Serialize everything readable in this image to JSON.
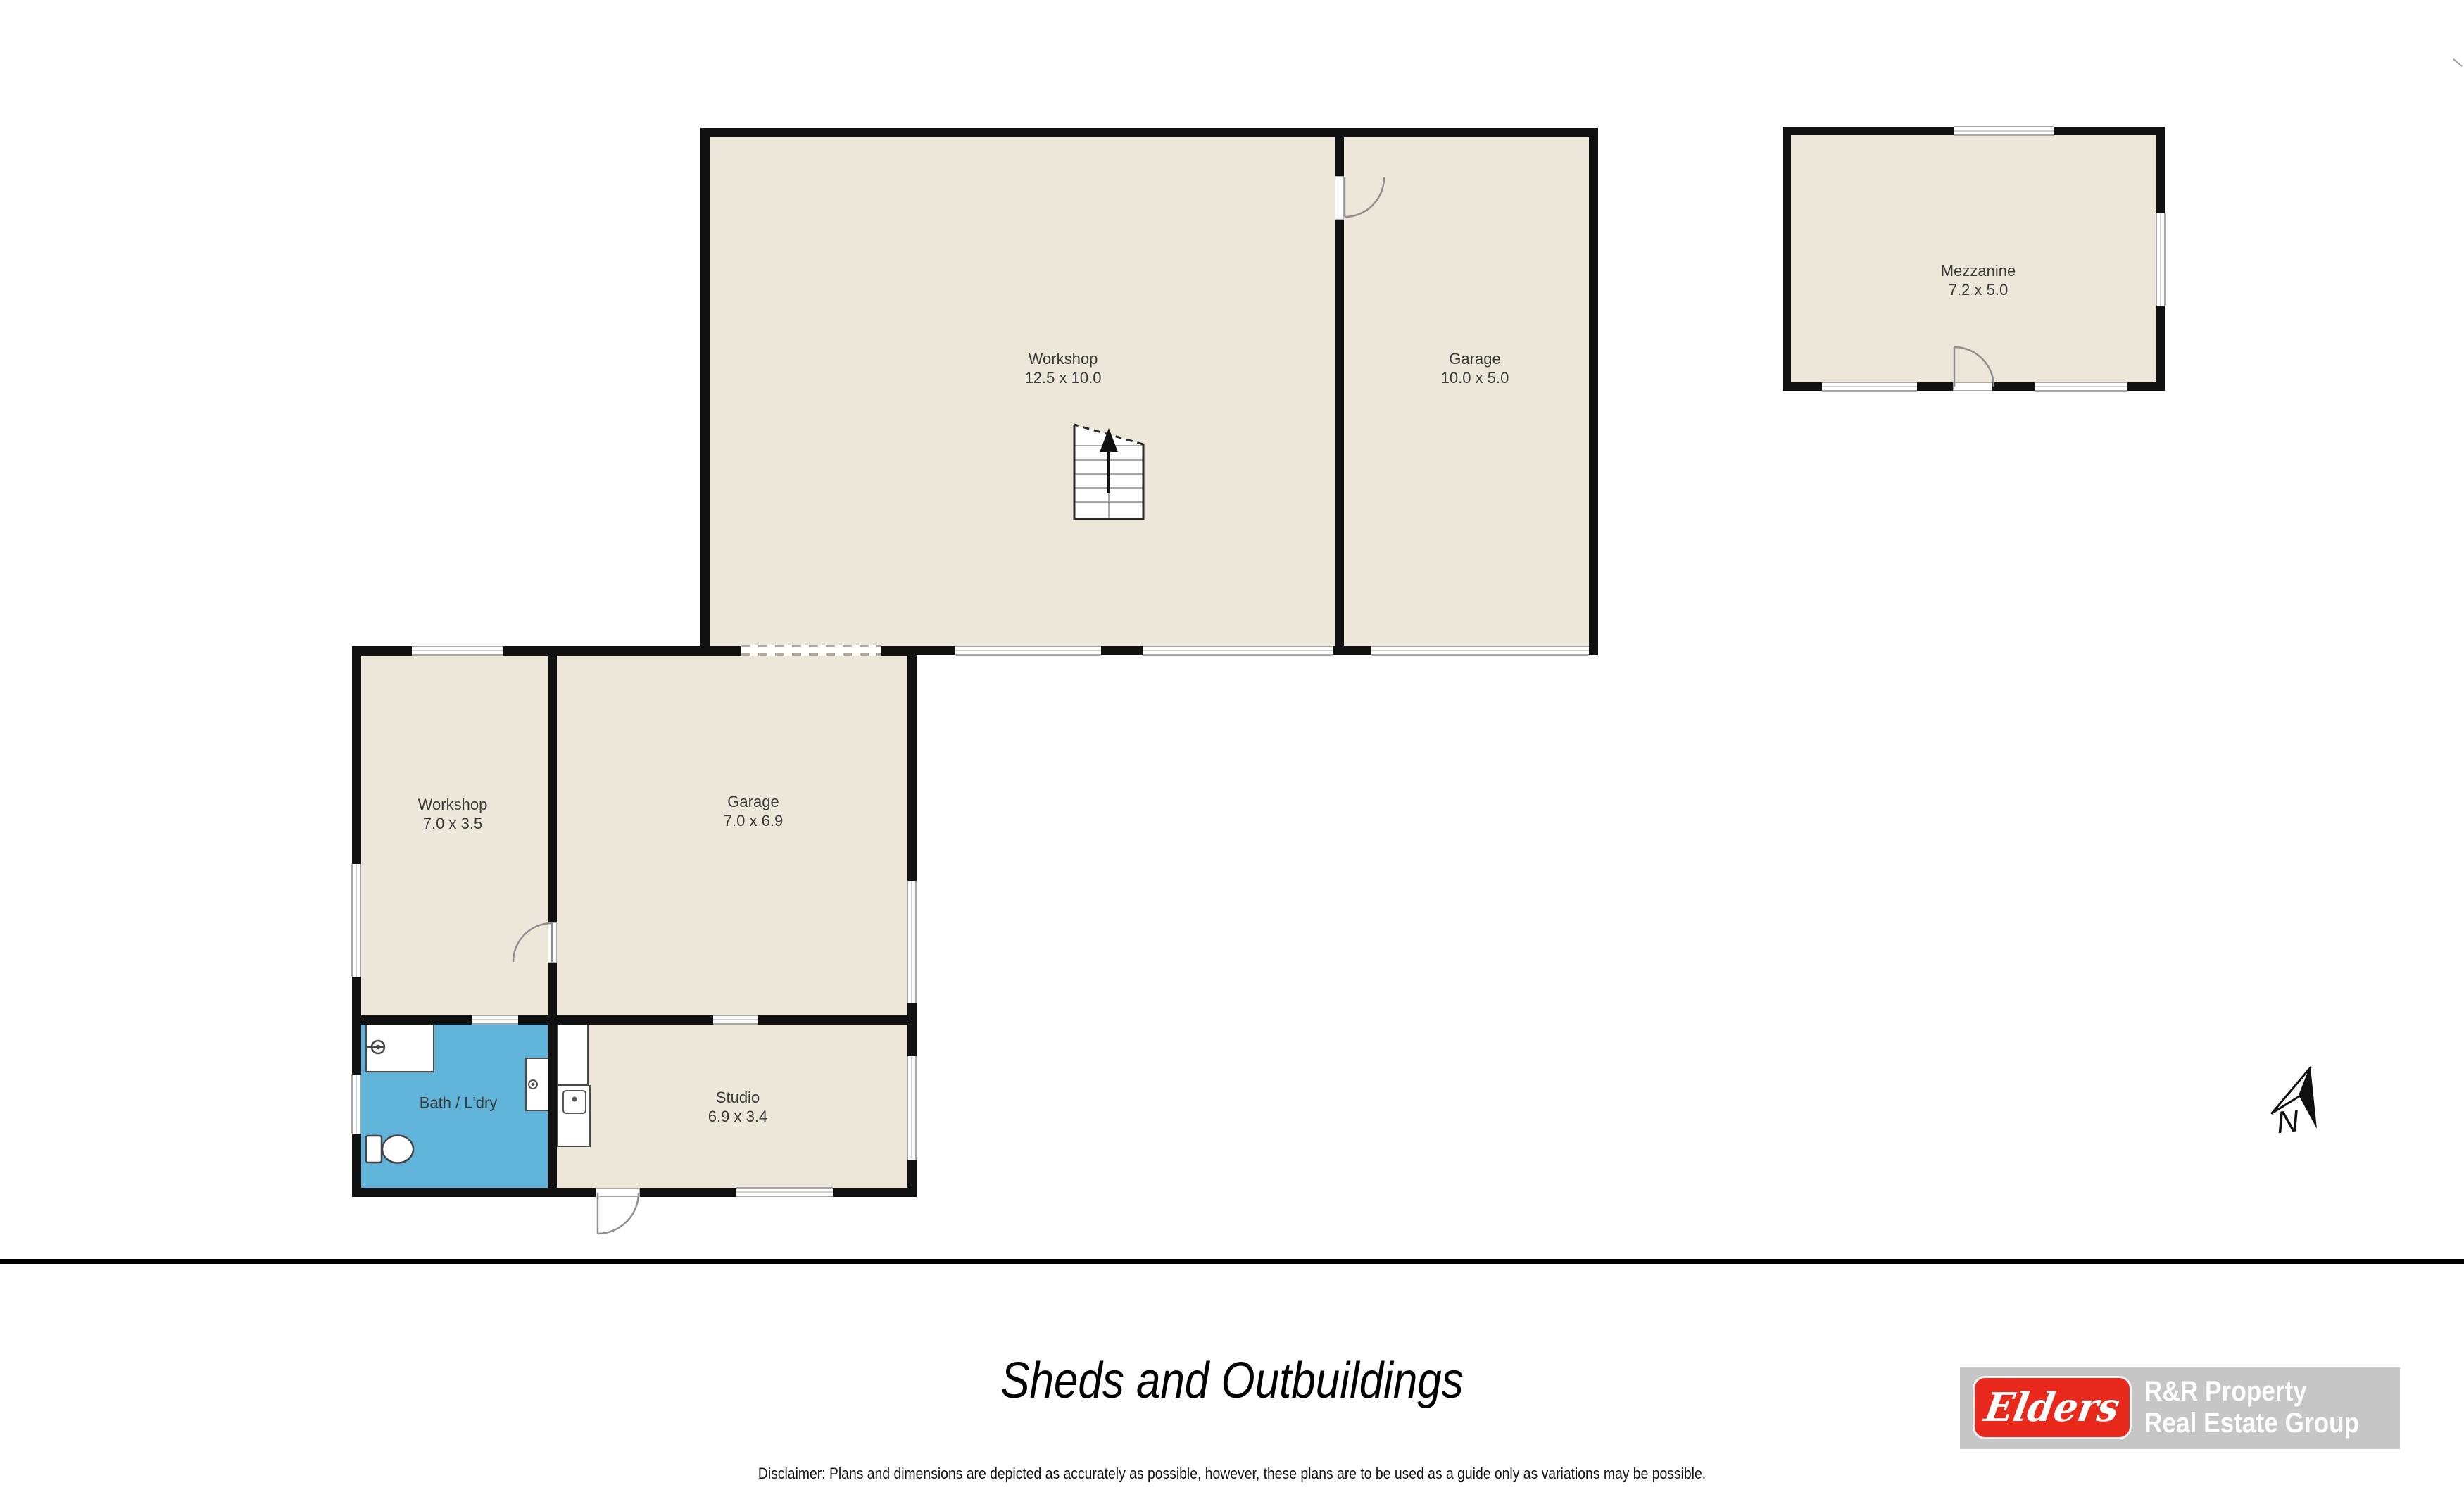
{
  "plan": {
    "title": "Sheds and Outbuildings",
    "disclaimer": "Disclaimer: Plans and dimensions are depicted as accurately as possible, however, these plans are to be used as a guide only as variations may be possible.",
    "north_label": "N",
    "rooms": {
      "workshop_main": {
        "name": "Workshop",
        "dims": "12.5 x 10.0"
      },
      "garage_main": {
        "name": "Garage",
        "dims": "10.0 x 5.0"
      },
      "mezzanine": {
        "name": "Mezzanine",
        "dims": "7.2 x 5.0"
      },
      "workshop_small": {
        "name": "Workshop",
        "dims": "7.0 x 3.5"
      },
      "garage_small": {
        "name": "Garage",
        "dims": "7.0 x 6.9"
      },
      "bath_laundry": {
        "name": "Bath / L'dry"
      },
      "studio": {
        "name": "Studio",
        "dims": "6.9 x 3.4"
      }
    },
    "colors": {
      "room_fill": "#EDE7DA",
      "wet_room_fill": "#60B4DA",
      "wall": "#111111",
      "window_line": "#A6A6A6",
      "brand_red": "#E8291C",
      "logo_banner": "#C6C6C6"
    }
  },
  "branding": {
    "logo_script": "Elders",
    "line1": "R&R Property",
    "line2": "Real Estate Group"
  }
}
